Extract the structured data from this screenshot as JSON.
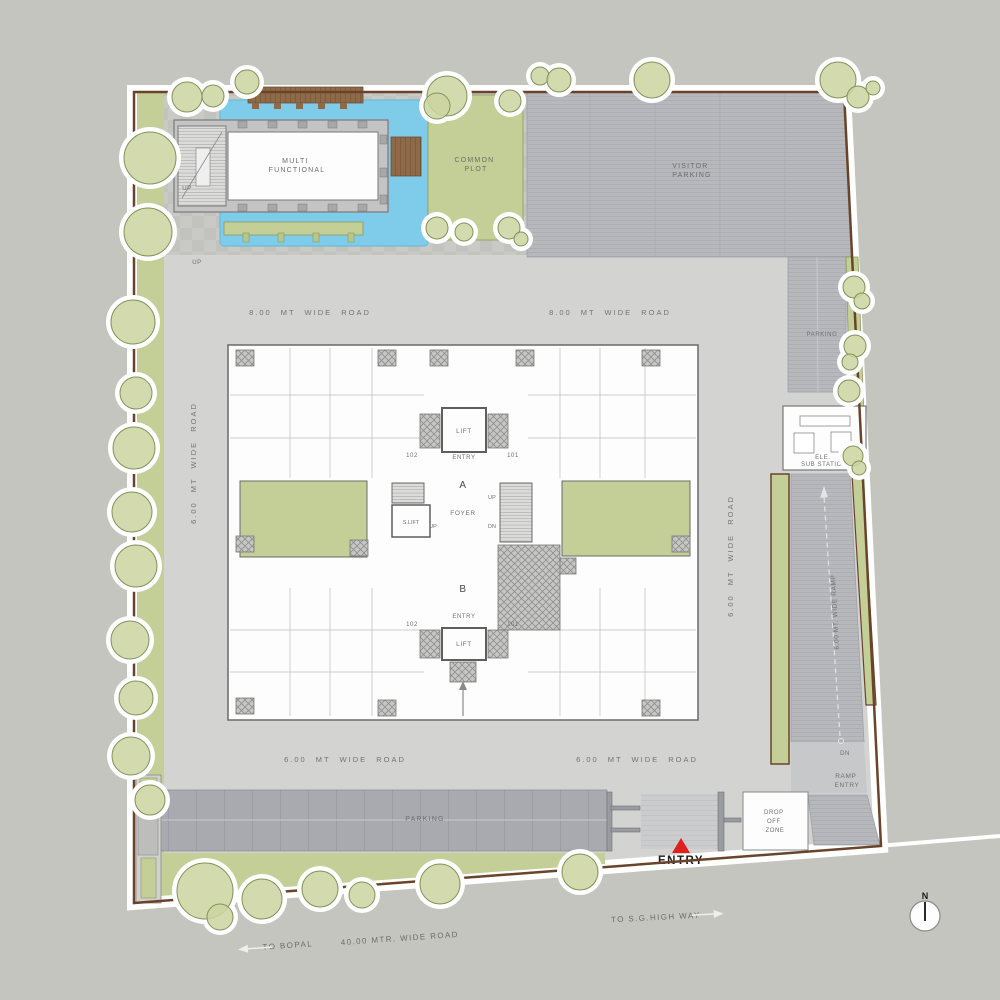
{
  "title": "Residential site plan (ground layout)",
  "labels": {
    "areas": {
      "multi_functional": [
        "MULTI",
        "FUNCTIONAL"
      ],
      "common_plot": [
        "COMMON",
        "PLOT"
      ],
      "visitor_parking": [
        "VISITOR",
        "PARKING"
      ],
      "parking_right": "PARKING",
      "parking_bottom": "PARKING",
      "ele_sub_station": [
        "ELE.",
        "SUB STATION"
      ],
      "ramp_entry": [
        "RAMP",
        "ENTRY"
      ],
      "drop_off_zone": [
        "DROP",
        "OFF",
        "ZONE"
      ],
      "dn_ramp": "DN"
    },
    "roads": {
      "mt8": "8.00 MT WIDE ROAD",
      "mt6": "6.00 MT WIDE ROAD",
      "ramp": "6.00 MT. WIDE RAMP",
      "mtr40": "40.00 MTR. WIDE ROAD"
    },
    "core": {
      "lift": "LIFT",
      "s_lift": "S.LIFT",
      "entry": "ENTRY",
      "unit_left": "102",
      "unit_right": "101",
      "block_a": "A",
      "block_b": "B",
      "foyer": "FOYER",
      "up": "UP",
      "dn": "DN"
    },
    "club": {
      "up": "UP"
    },
    "entry_gate": {
      "label": "ENTRY"
    },
    "directions": {
      "to_bopal": "TO BOPAL",
      "to_sg_highway": "TO S.G.HIGH WAY",
      "north": "N"
    }
  },
  "colors": {
    "background": "#c5c5bf",
    "site_ground": "#d3d3d1",
    "green": "#c3cf97",
    "green_stroke": "#8a9960",
    "pool_blue": "#7ecce9",
    "deck_brown": "#8f6a49",
    "boundary_brown": "#6a442a",
    "parking_gray": "#a8aaaf",
    "visitor_parking_gray": "#b6b8bc",
    "wall_gray": "#6a6a6a",
    "entry_red": "#e01f1f",
    "building_white": "#fdfdfd"
  }
}
